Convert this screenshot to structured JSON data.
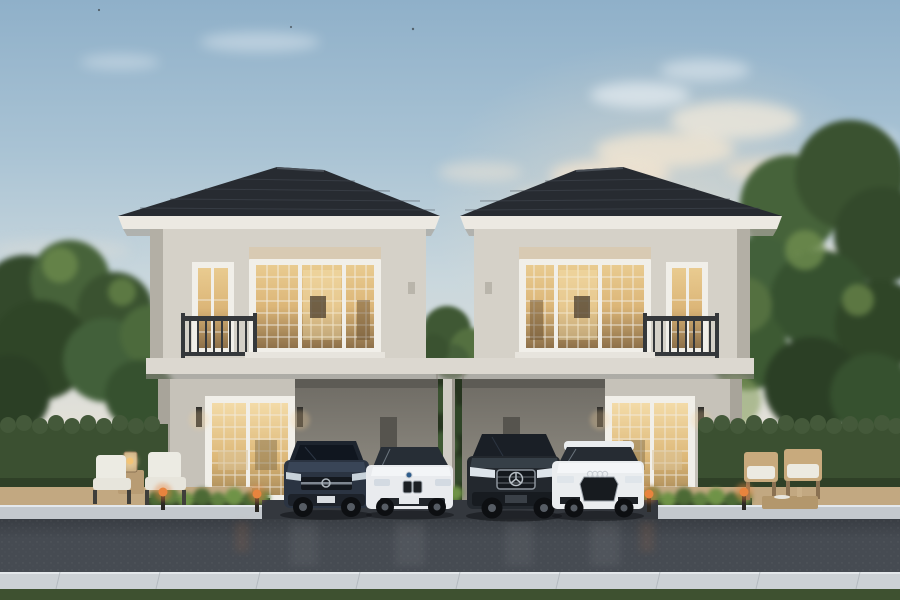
{
  "scene": {
    "title": "Twin two-storey detached houses at dusk — exterior rendering",
    "time_of_day": "dusk",
    "houses": [
      {
        "label": "left-house",
        "storeys": 2,
        "features": [
          "dark hip tile roof",
          "lit grid window upstairs",
          "balcony with dark railing on left",
          "roller shades",
          "french door downstairs",
          "carport on right"
        ]
      },
      {
        "label": "right-house",
        "storeys": 2,
        "features": [
          "dark hip tile roof",
          "lit grid window upstairs",
          "balcony with dark railing on right",
          "roller shades",
          "french door downstairs",
          "carport on left"
        ]
      }
    ],
    "cars": [
      {
        "label": "dark-blue-gray suv",
        "position": "left carport"
      },
      {
        "label": "white sedan with twin-kidney grille",
        "position": "left of center post"
      },
      {
        "label": "dark suv with star grille",
        "position": "right of center post"
      },
      {
        "label": "white hatchback with large hex grille",
        "position": "right carport"
      }
    ],
    "landscape": [
      "tall trees left and right",
      "clipped hedge walls",
      "shrub planters",
      "tan patio pavers",
      "asphalt road",
      "light stone gutter",
      "grass strip at bottom"
    ],
    "furniture": [
      "two cushioned patio chairs with lantern table (left)",
      "two wooden lounge chairs with low table (right)",
      "orange glowing garden bollard lamps"
    ]
  },
  "colors": {
    "roof": "#272b31",
    "fascia": "#ece9e2",
    "wall_upper": "#d5d1c8",
    "wall_ground": "#c6c2b9",
    "band": "#dcd8d0",
    "window_frame": "#f1efe9",
    "hedge": "#3b5031",
    "grass": "#3e5130",
    "road": "#464b52",
    "driveway": "#34383e",
    "curb": "#c3c8cd",
    "gutter": "#ccd1d5",
    "patio": "#c2a881",
    "lamp": "#e8843e",
    "car_suv": "#2b3442",
    "car_bmw": "#e9ebee",
    "car_mb": "#23282e",
    "car_audi": "#eaedef"
  }
}
